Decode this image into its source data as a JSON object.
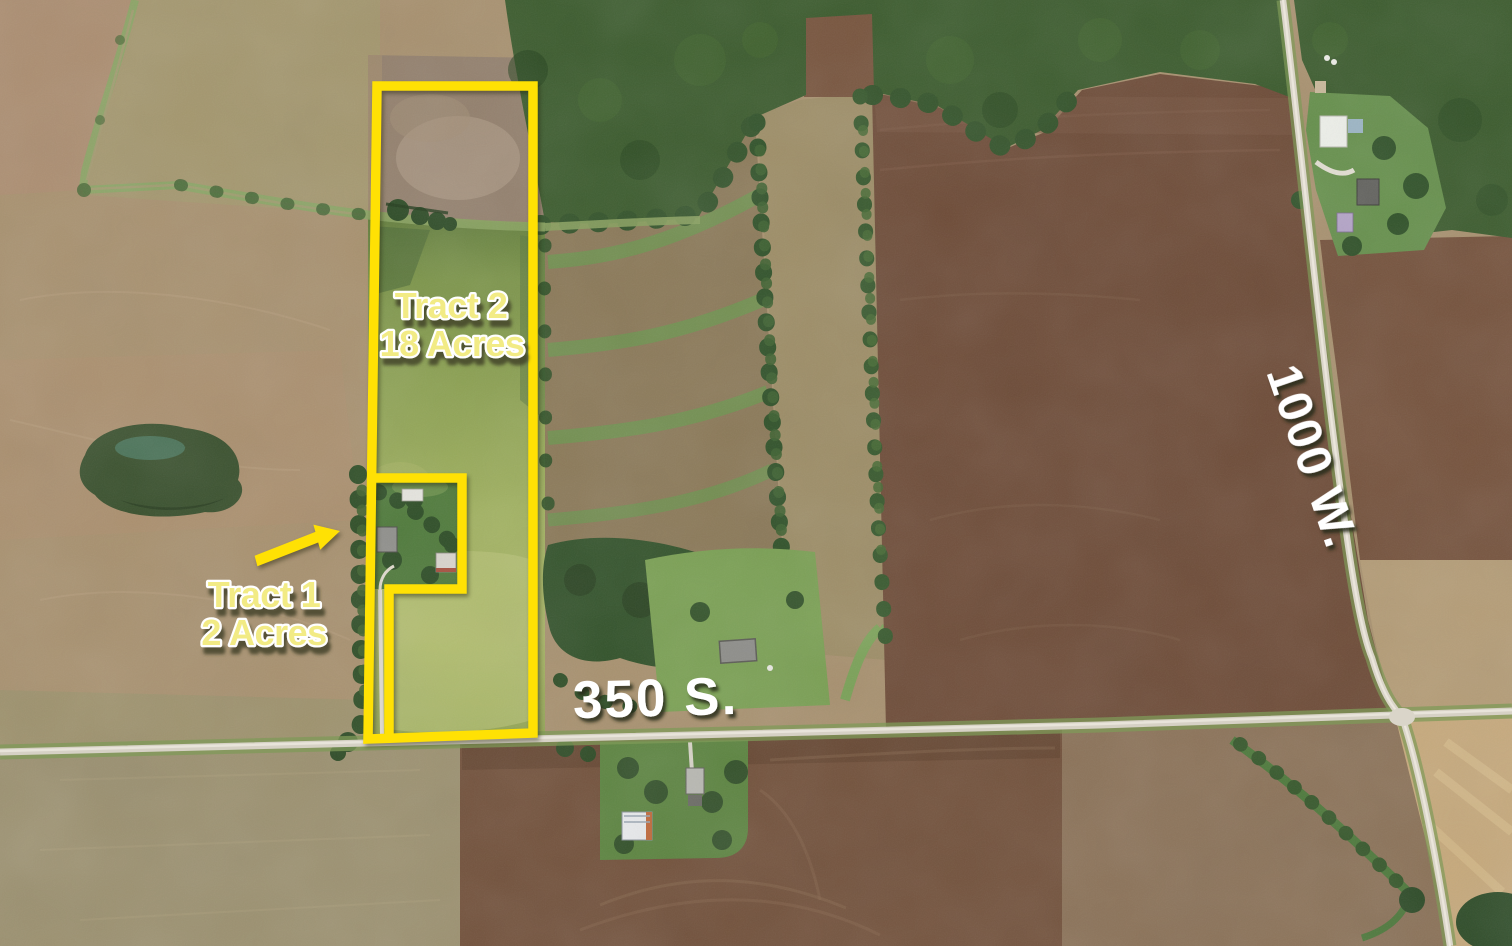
{
  "annotations": {
    "tract2": {
      "line1": "Tract 2",
      "line2": "18 Acres"
    },
    "tract1": {
      "line1": "Tract 1",
      "line2": "2 Acres"
    },
    "road_ew": "350 S.",
    "road_ns": "1000 W."
  },
  "colors": {
    "tract_outline": "#ffe104",
    "tract_label": "#f2eb85",
    "label_outline": "#ffffff",
    "road_label": "#ffffff"
  }
}
